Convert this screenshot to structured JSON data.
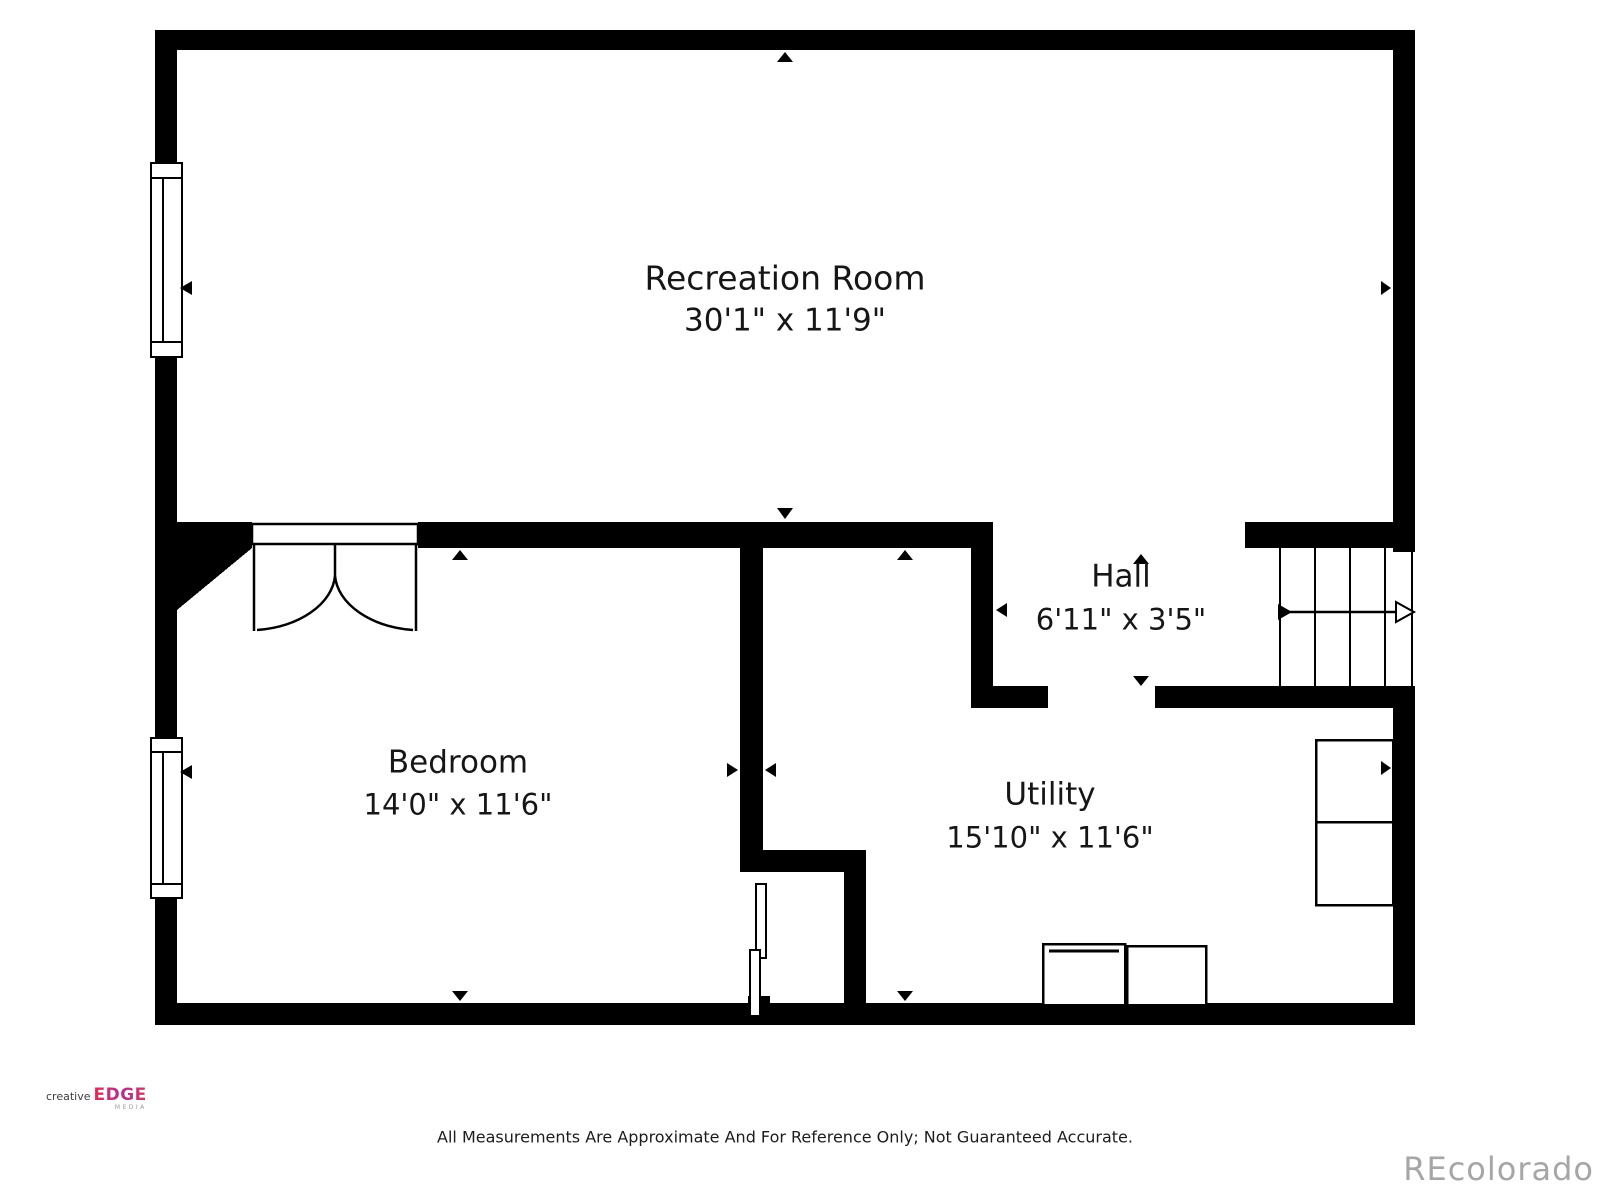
{
  "page": {
    "disclaimer": "All Measurements Are Approximate And For Reference Only; Not Guaranteed Accurate.",
    "watermark": "REcolorado",
    "background_color": "#ffffff",
    "wall_color": "#000000",
    "watermark_color": "#a6a6a6"
  },
  "logo": {
    "creative": "creative",
    "edge": "EDGE",
    "media": "MEDIA",
    "edge_gradient_start": "#e22c52",
    "edge_gradient_end": "#b03390"
  },
  "rooms": {
    "recreation": {
      "name": "Recreation Room",
      "dims": "30'1\" x 11'9\""
    },
    "bedroom": {
      "name": "Bedroom",
      "dims": "14'0\" x 11'6\""
    },
    "hall": {
      "name": "Hall",
      "dims": "6'11\" x 3'5\""
    },
    "utility": {
      "name": "Utility",
      "dims": "15'10\" x 11'6\""
    }
  },
  "symbols": {
    "windows": 2,
    "double_door": "bedroom-entry",
    "sliding_door": "closet",
    "stairs_direction": "right"
  }
}
